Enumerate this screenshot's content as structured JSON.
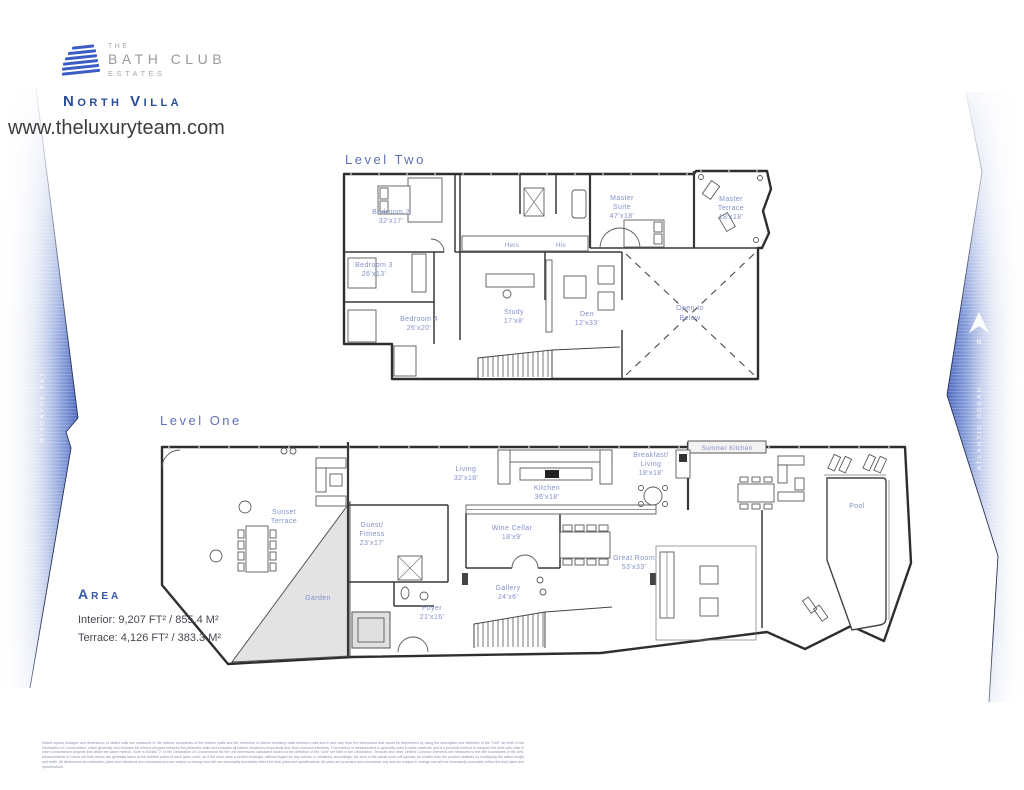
{
  "header": {
    "logo": {
      "line1": "THE",
      "line2": "BATH CLUB",
      "line3": "ESTATES"
    },
    "villa_name": "North Villa",
    "website": "www.theluxuryteam.com"
  },
  "environment": {
    "left_waterway": "BISCAYNE BAY",
    "right_waterway": "ATLANTIC OCEAN",
    "compass_label": "N"
  },
  "level_two": {
    "title": "Level Two",
    "rooms": {
      "bedroom2": {
        "lines": [
          "Bedroom 2",
          "32'x17'"
        ]
      },
      "bedroom3": {
        "lines": [
          "Bedroom 3",
          "26'x13'"
        ]
      },
      "bedroom4": {
        "lines": [
          "Bedroom 4",
          "26'x20'"
        ]
      },
      "hers": {
        "lines": [
          "Hers"
        ]
      },
      "his": {
        "lines": [
          "His"
        ]
      },
      "master_suite": {
        "lines": [
          "Master",
          "Suite",
          "47'x18'"
        ]
      },
      "master_terrace": {
        "lines": [
          "Master",
          "Terrace",
          "18'x18'"
        ]
      },
      "study": {
        "lines": [
          "Study",
          "17'x8'"
        ]
      },
      "den": {
        "lines": [
          "Den",
          "12'x33'"
        ]
      },
      "open_to_below": {
        "lines": [
          "Open to",
          "Below"
        ]
      }
    }
  },
  "level_one": {
    "title": "Level One",
    "rooms": {
      "sunset_terrace": {
        "lines": [
          "Sunset",
          "Terrace"
        ]
      },
      "garden": {
        "lines": [
          "Garden"
        ]
      },
      "guest_fitness": {
        "lines": [
          "Guest/",
          "Fitness",
          "23'x17'"
        ]
      },
      "living": {
        "lines": [
          "Living",
          "32'x18'"
        ]
      },
      "kitchen": {
        "lines": [
          "Kitchen",
          "36'x18'"
        ]
      },
      "wine_cellar": {
        "lines": [
          "Wine Cellar",
          "18'x9'"
        ]
      },
      "gallery": {
        "lines": [
          "Gallery",
          "24'x6'"
        ]
      },
      "foyer": {
        "lines": [
          "Foyer",
          "21'x16'"
        ]
      },
      "breakfast_living": {
        "lines": [
          "Breakfast/",
          "Living",
          "18'x18'"
        ]
      },
      "great_room": {
        "lines": [
          "Great Room",
          "53'x33'"
        ]
      },
      "summer_kitchen": {
        "lines": [
          "Summer Kitchen"
        ]
      },
      "pool": {
        "lines": [
          "Pool"
        ]
      }
    }
  },
  "area": {
    "heading": "Area",
    "interior": "Interior: 9,207 FT² / 855.4 M²",
    "terrace": "Terrace: 4,126 FT² / 383.3 M²"
  },
  "disclaimer": "Stated square footages and dimensions of stated units are measured to the exterior boundaries of the exterior walls and the centerline of interior demising walls between units and in fact vary from the dimensions that would be determined by using the description and definition of the \"Unit\" set forth in the Declaration of Condominium, which generally only includes the interior airspace between the perimeter walls and excludes all interior structural components and other common elements. This method of measurement is generally used in sales materials and is a practical method to compare the units with units in other condominium projects that utilize the same method. Note in Exhibit \"2\" to the Declaration of Condominium list the unit dimensions calculated based on the definition of the \"Unit\" set forth in the Declaration. Terraces and other Limited Common Elements are measured to the title boundaries of the Unit. Measurements of rooms set forth herein are generally taken at the furthest points of each given room, as if the room were a perfect rectangle, without regard for any cutouts or variations; accordingly, the area of the actual room will typically be smaller than the product obtained by multiplying the stated length and width. All dimensions are estimates, plans and elevations are conceptual and are subject to change and will not necessarily accurately reflect the final plans and specifications. All plans are proposed and conceptual only and are subject to change and will not necessarily accurately reflect the final plans and specifications.",
  "colors": {
    "brand_blue": "#2b4d9c",
    "label_blue": "#8590c9",
    "ribbon_blue": "#4c69bd",
    "logo_gray": "#9a9a9a",
    "wall_dark": "#2e2e2e"
  }
}
